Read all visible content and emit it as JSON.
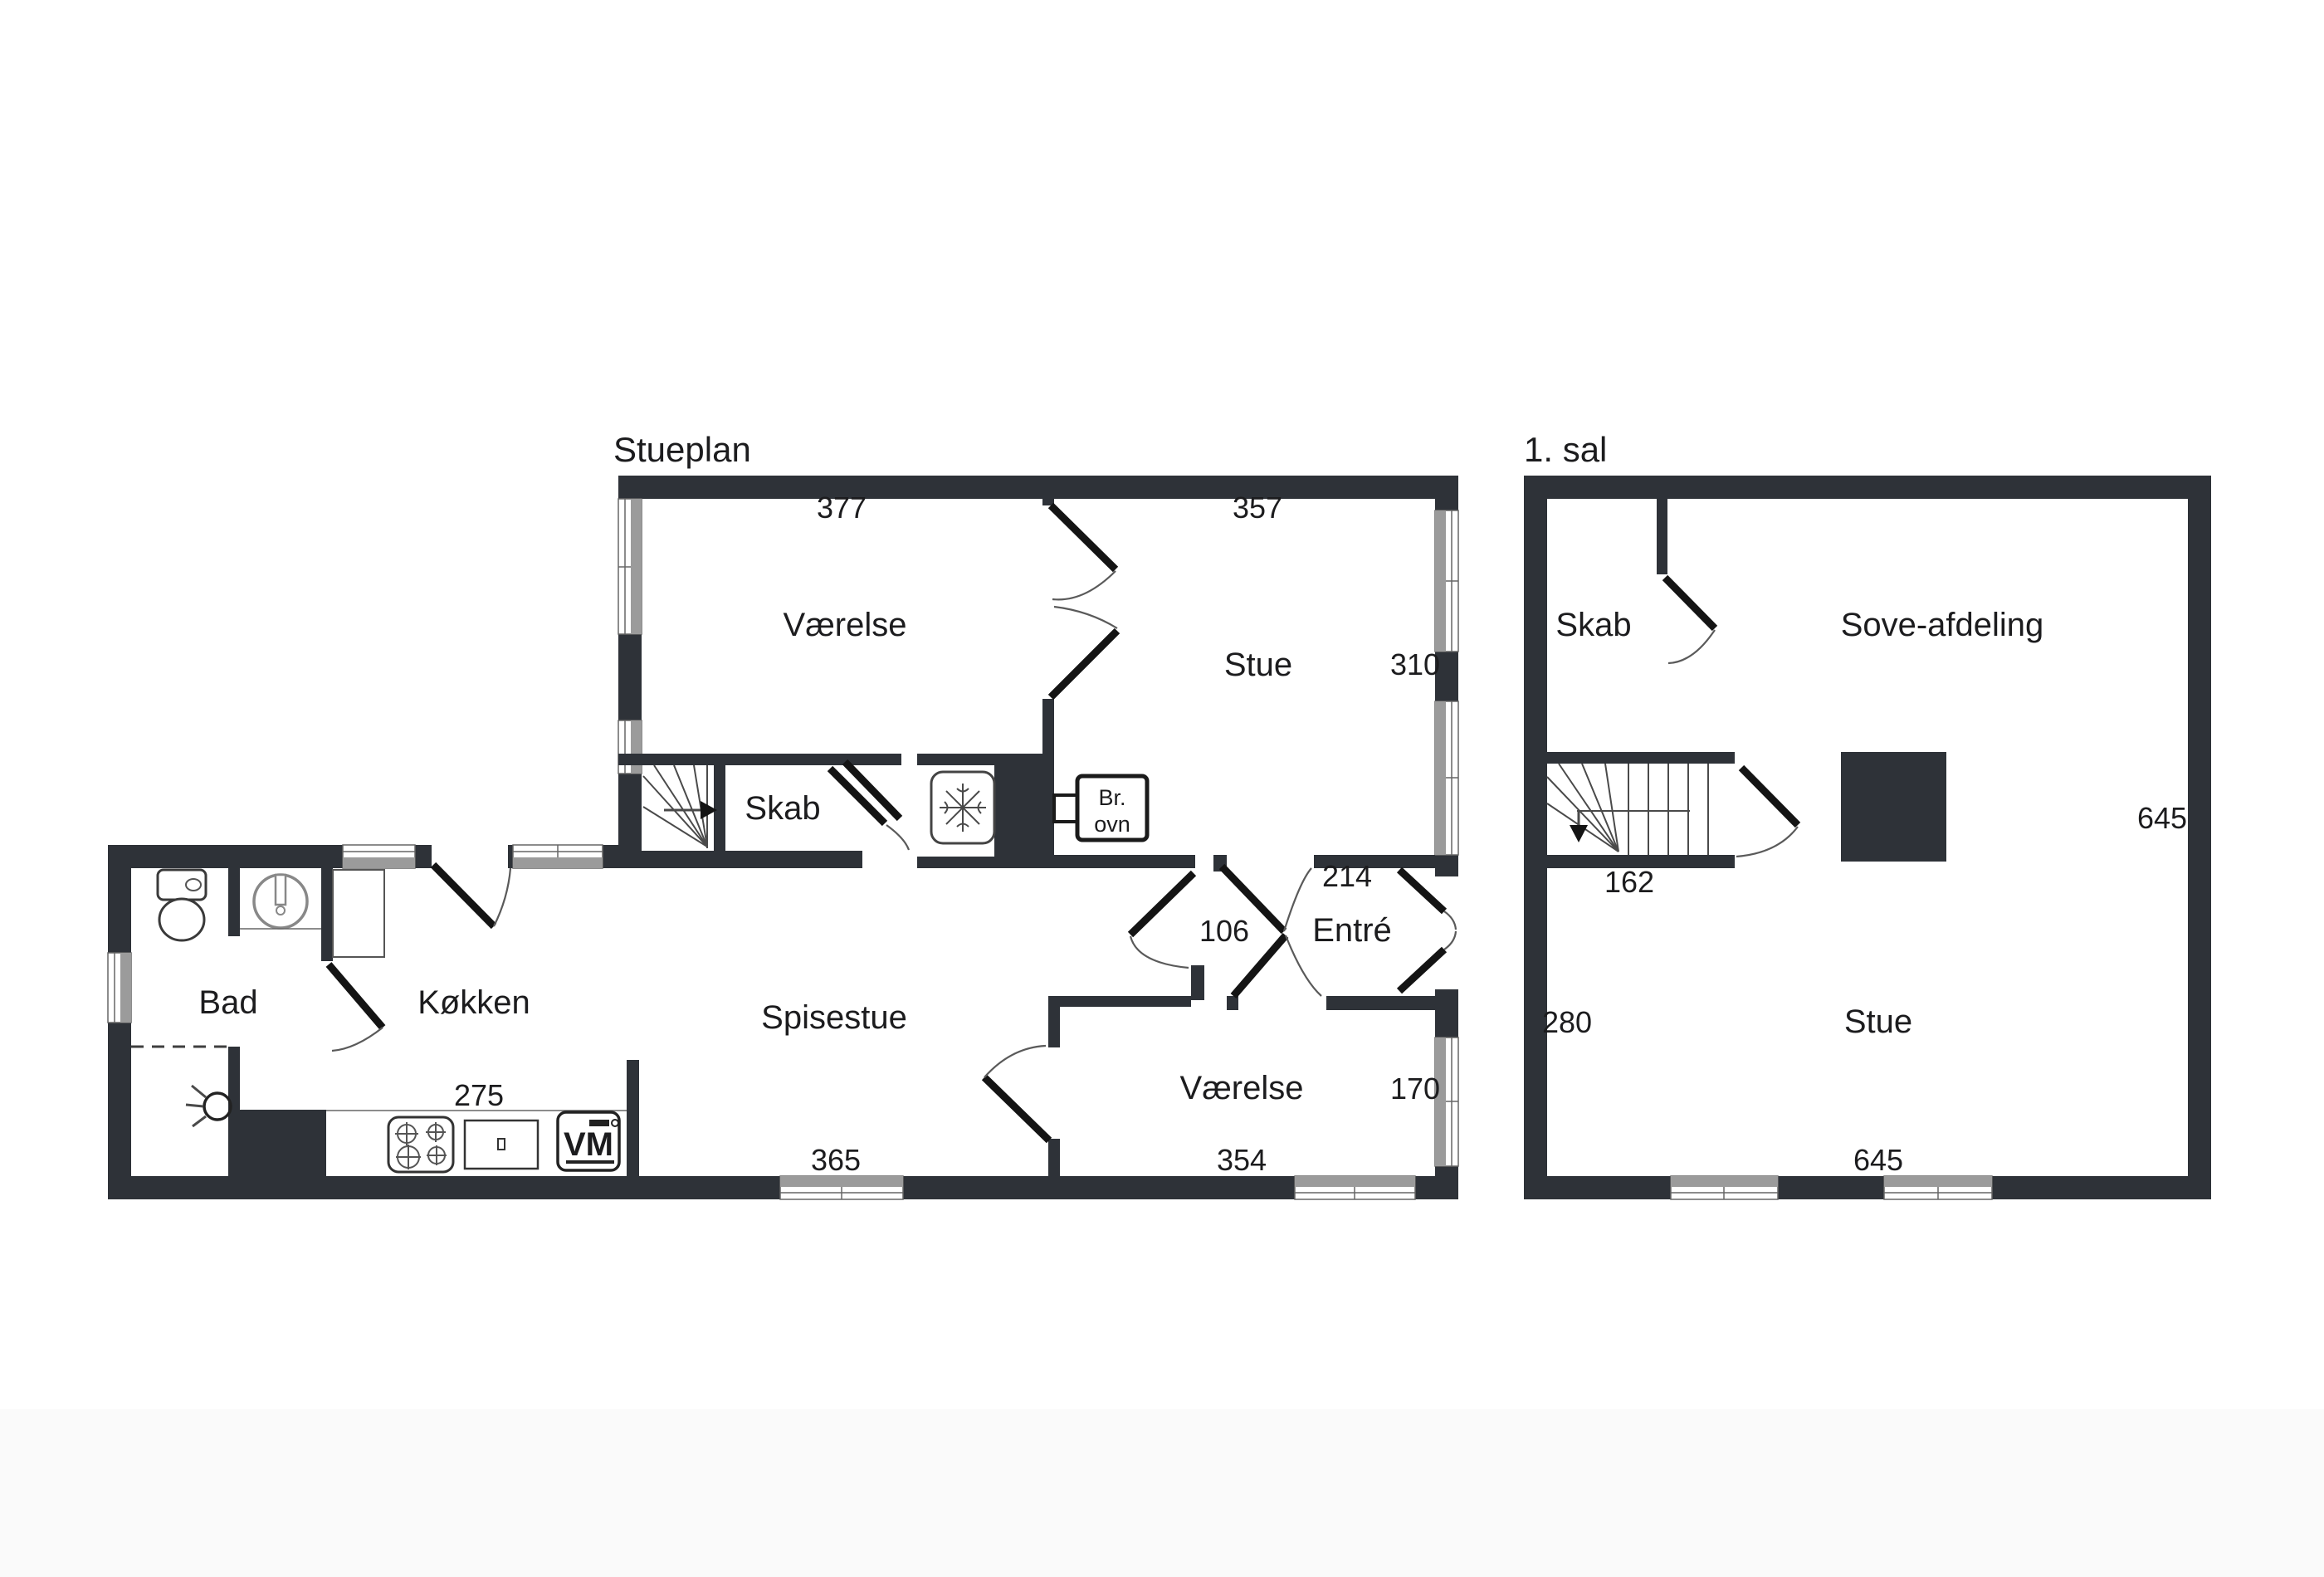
{
  "page": {
    "background": "#ffffff",
    "footer_band_color": "#fafafa"
  },
  "colors": {
    "wall": "#2e3238",
    "text": "#1c1c1e",
    "window_gray": "#9b9b9b",
    "door_leaf": "#141414"
  },
  "ground_floor": {
    "title": "Stueplan",
    "rooms": {
      "bedroom_top": "Værelse",
      "living_room": "Stue",
      "closet": "Skab",
      "bathroom": "Bad",
      "kitchen": "Køkken",
      "dining_room": "Spisestue",
      "entry": "Entré",
      "bedroom_bottom": "Værelse"
    },
    "fixtures": {
      "wood_stove_line1": "Br.",
      "wood_stove_line2": "ovn",
      "washing_machine": "VM"
    },
    "dimensions": {
      "bedroom_top_width": "377",
      "living_width": "357",
      "living_depth": "310",
      "entry_width": "214",
      "passage_width": "106",
      "kitchen_width": "275",
      "dining_width": "365",
      "bedroom_bottom_width": "354",
      "bedroom_bottom_depth": "170"
    }
  },
  "first_floor": {
    "title": "1. sal",
    "rooms": {
      "closet": "Skab",
      "sleeping_area": "Sove-afdeling",
      "living_room": "Stue"
    },
    "dimensions": {
      "stair_width": "162",
      "left_depth": "280",
      "right_depth": "645",
      "bottom_width": "645"
    }
  }
}
